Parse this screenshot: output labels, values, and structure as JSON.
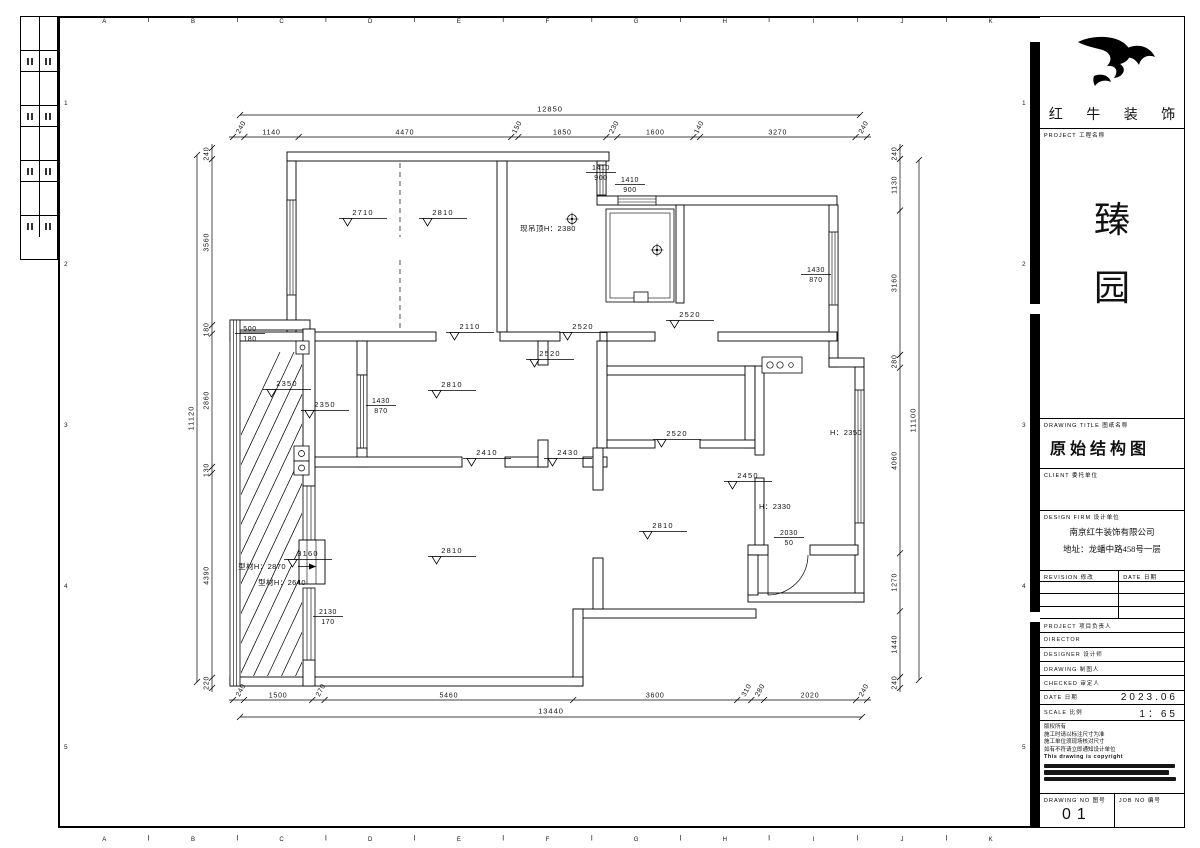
{
  "sheet": {
    "grid_letters": [
      "A",
      "B",
      "C",
      "D",
      "E",
      "F",
      "G",
      "H",
      "I",
      "J",
      "K"
    ],
    "grid_numbers": [
      "1",
      "2",
      "3",
      "4",
      "5"
    ],
    "paper_color": "#ffffff",
    "line_color": "#000000"
  },
  "title_block": {
    "brand": {
      "logo_icon": "bull-swoosh-logo",
      "name": "红 牛 装 饰"
    },
    "project": {
      "label": "PROJECT 工程名称",
      "name_chars": [
        "臻",
        "园"
      ]
    },
    "drawing_title": {
      "label": "DRAWING TITLE 图纸名称",
      "value": "原始结构图"
    },
    "client": {
      "label": "CLIENT 委托单位"
    },
    "design_firm": {
      "label": "DESIGN FIRM 设计单位",
      "line1": "南京红牛装饰有限公司",
      "line2": "地址：龙蟠中路458号一层"
    },
    "revision_table": {
      "col1": "REVISION 修改",
      "col2": "DATE 日期"
    },
    "staff_rows": [
      {
        "label": "PROJECT 项目负责人",
        "value": ""
      },
      {
        "label": "DIRECTOR",
        "value": ""
      },
      {
        "label": "DESIGNER 设计师",
        "value": ""
      },
      {
        "label": "DRAWING 制图人",
        "value": ""
      },
      {
        "label": "CHECKED 审定人",
        "value": ""
      },
      {
        "label": "DATE 日期",
        "value": "2023.06"
      },
      {
        "label": "SCALE 比例",
        "value": "1：65"
      }
    ],
    "notes": [
      "版权所有",
      "施工时请以标注尺寸为准",
      "施工单位须现场核对尺寸",
      "如有不符请立即通知设计单位",
      "This drawing is copyright"
    ],
    "drawing_no": {
      "label": "DRAWING NO 图号",
      "value": "01"
    },
    "job_no": {
      "label": "JOB NO 编号",
      "value": ""
    }
  },
  "plan": {
    "dims": {
      "top": {
        "overall": "12850",
        "parts": [
          "240",
          "1140",
          "4470",
          "150",
          "1850",
          "230",
          "1600",
          "140",
          "3270",
          "240"
        ]
      },
      "bottom": {
        "overall": "13440",
        "parts": [
          "240",
          "1500",
          "270",
          "5460",
          "3600",
          "310",
          "280",
          "2020",
          "240"
        ]
      },
      "left": {
        "overall": "11120",
        "parts": [
          "240",
          "3560",
          "180",
          "2860",
          "130",
          "4390",
          "220"
        ]
      },
      "right": {
        "overall": "11100",
        "parts": [
          "240",
          "1130",
          "3160",
          "280",
          "4060",
          "1270",
          "1440",
          "240"
        ]
      }
    },
    "labels": {
      "elevations": [
        {
          "t": "2710",
          "x": 363,
          "y": 215
        },
        {
          "t": "2810",
          "x": 443,
          "y": 215
        },
        {
          "t": "2110",
          "x": 470,
          "y": 329
        },
        {
          "t": "2520",
          "x": 583,
          "y": 329
        },
        {
          "t": "2520",
          "x": 690,
          "y": 317
        },
        {
          "t": "2350",
          "x": 287,
          "y": 386
        },
        {
          "t": "2350",
          "x": 325,
          "y": 407
        },
        {
          "t": "2810",
          "x": 452,
          "y": 387
        },
        {
          "t": "2520",
          "x": 550,
          "y": 356
        },
        {
          "t": "2410",
          "x": 487,
          "y": 455
        },
        {
          "t": "2430",
          "x": 568,
          "y": 455
        },
        {
          "t": "2520",
          "x": 677,
          "y": 436
        },
        {
          "t": "2450",
          "x": 748,
          "y": 478
        },
        {
          "t": "2810",
          "x": 663,
          "y": 528
        },
        {
          "t": "2810",
          "x": 452,
          "y": 553
        },
        {
          "t": "3160",
          "x": 308,
          "y": 556
        }
      ],
      "fractions": [
        {
          "a": "1410",
          "b": "900",
          "x": 601,
          "y": 170
        },
        {
          "a": "1410",
          "b": "900",
          "x": 630,
          "y": 182
        },
        {
          "a": "1430",
          "b": "870",
          "x": 816,
          "y": 272
        },
        {
          "a": "500",
          "b": "180",
          "x": 250,
          "y": 331
        },
        {
          "a": "1430",
          "b": "870",
          "x": 381,
          "y": 403
        },
        {
          "a": "2030",
          "b": "50",
          "x": 789,
          "y": 535
        },
        {
          "a": "2130",
          "b": "170",
          "x": 328,
          "y": 614
        }
      ],
      "texts": [
        {
          "t": "现吊顶H：2380",
          "x": 548,
          "y": 231
        },
        {
          "t": "H：2350",
          "x": 846,
          "y": 435
        },
        {
          "t": "H：2330",
          "x": 775,
          "y": 509
        },
        {
          "t": "型材H：2870",
          "x": 262,
          "y": 569,
          "arrow": true
        },
        {
          "t": "型材H：2640",
          "x": 282,
          "y": 585
        }
      ]
    }
  }
}
